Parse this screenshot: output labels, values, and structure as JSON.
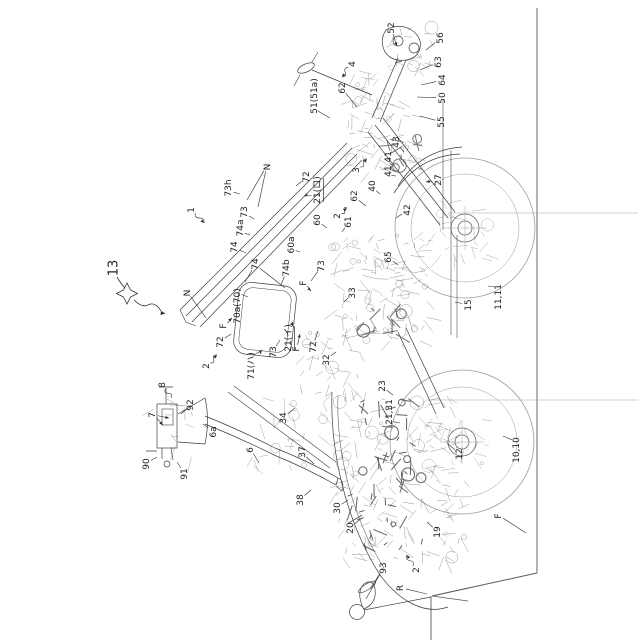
{
  "figure": {
    "kind": "patent-line-drawing",
    "orientation": "rotated-90-ccw",
    "background": "#ffffff",
    "ink": "#3a3a3a",
    "faint_ink": "#8a8a8a",
    "label_color": "#1f1f1f",
    "label_font_size": 9,
    "big_label_font_size": 13
  },
  "labels": [
    {
      "t": "13",
      "x": 113,
      "y": 268,
      "s": 13,
      "l": []
    },
    {
      "t": "1",
      "x": 191,
      "y": 210,
      "w": true,
      "a": true,
      "l": [
        [
          204,
          223
        ]
      ]
    },
    {
      "t": "2",
      "x": 337,
      "y": 216,
      "w": true,
      "a": true,
      "l": [
        [
          347,
          208
        ]
      ]
    },
    {
      "t": "2",
      "x": 206,
      "y": 366,
      "w": true,
      "a": true,
      "l": [
        [
          217,
          355
        ]
      ]
    },
    {
      "t": "2",
      "x": 416,
      "y": 570,
      "w": true,
      "a": true,
      "l": [
        [
          407,
          555
        ]
      ]
    },
    {
      "t": "3",
      "x": 356,
      "y": 170,
      "w": true,
      "a": true,
      "l": [
        [
          367,
          159
        ]
      ]
    },
    {
      "t": "4",
      "x": 352,
      "y": 64,
      "w": true,
      "a": true,
      "l": [
        [
          342,
          77
        ]
      ]
    },
    {
      "t": "52",
      "x": 391,
      "y": 28,
      "a": true,
      "l": [
        [
          397,
          46
        ]
      ]
    },
    {
      "t": "56",
      "x": 440,
      "y": 38,
      "l": [
        [
          426,
          50
        ]
      ]
    },
    {
      "t": "63",
      "x": 438,
      "y": 62,
      "l": [
        [
          420,
          70
        ]
      ]
    },
    {
      "t": "64",
      "x": 442,
      "y": 80,
      "l": [
        [
          421,
          85
        ]
      ]
    },
    {
      "t": "50",
      "x": 442,
      "y": 98,
      "l": [
        [
          417,
          97
        ]
      ]
    },
    {
      "t": "55",
      "x": 441,
      "y": 122,
      "l": [
        [
          420,
          116
        ]
      ]
    },
    {
      "t": "62",
      "x": 342,
      "y": 88,
      "l": [
        [
          357,
          107
        ]
      ]
    },
    {
      "t": "51(51a)",
      "x": 314,
      "y": 96,
      "l": [
        [
          330,
          118
        ]
      ]
    },
    {
      "t": "43",
      "x": 396,
      "y": 142,
      "l": [
        [
          404,
          152
        ]
      ]
    },
    {
      "t": "41,41",
      "x": 388,
      "y": 164,
      "l": [
        [
          396,
          176
        ]
      ]
    },
    {
      "t": "40",
      "x": 372,
      "y": 186,
      "l": [
        [
          380,
          194
        ]
      ]
    },
    {
      "t": "62",
      "x": 354,
      "y": 196,
      "l": [
        [
          366,
          206
        ]
      ]
    },
    {
      "t": "27",
      "x": 438,
      "y": 180,
      "a": true,
      "l": [
        [
          426,
          182
        ]
      ]
    },
    {
      "t": "42",
      "x": 407,
      "y": 210,
      "l": [
        [
          396,
          218
        ]
      ]
    },
    {
      "t": "21(ロ)",
      "x": 317,
      "y": 190,
      "u": true,
      "a": true,
      "l": [
        [
          304,
          196
        ]
      ]
    },
    {
      "t": "72",
      "x": 306,
      "y": 177,
      "l": [
        [
          296,
          186
        ]
      ]
    },
    {
      "t": "N",
      "x": 267,
      "y": 167,
      "l": [
        [
          247,
          200
        ],
        [
          258,
          207
        ]
      ]
    },
    {
      "t": "73h",
      "x": 228,
      "y": 188,
      "l": [
        [
          240,
          194
        ]
      ]
    },
    {
      "t": "73",
      "x": 244,
      "y": 212,
      "l": [
        [
          254,
          219
        ]
      ]
    },
    {
      "t": "74a",
      "x": 240,
      "y": 228,
      "l": [
        [
          250,
          235
        ]
      ]
    },
    {
      "t": "74",
      "x": 234,
      "y": 247,
      "l": [
        [
          246,
          253
        ]
      ]
    },
    {
      "t": "60",
      "x": 317,
      "y": 220,
      "l": [
        [
          327,
          228
        ]
      ]
    },
    {
      "t": "61",
      "x": 348,
      "y": 222,
      "l": [
        [
          342,
          232
        ]
      ]
    },
    {
      "t": "60a",
      "x": 291,
      "y": 245,
      "l": [
        [
          300,
          252
        ]
      ]
    },
    {
      "t": "74",
      "x": 255,
      "y": 264,
      "l": [
        [
          245,
          282
        ],
        [
          285,
          288
        ]
      ]
    },
    {
      "t": "74b",
      "x": 286,
      "y": 268,
      "l": [
        [
          281,
          285
        ]
      ]
    },
    {
      "t": "73",
      "x": 321,
      "y": 266,
      "l": [
        [
          311,
          281
        ]
      ]
    },
    {
      "t": "F",
      "x": 303,
      "y": 283,
      "a": true,
      "l": [
        [
          311,
          291
        ]
      ]
    },
    {
      "t": "65",
      "x": 388,
      "y": 257,
      "l": [
        [
          398,
          265
        ]
      ]
    },
    {
      "t": "33",
      "x": 352,
      "y": 293,
      "l": [
        [
          344,
          302
        ]
      ]
    },
    {
      "t": "70a(70)",
      "x": 237,
      "y": 306,
      "l": [
        [
          248,
          297
        ]
      ]
    },
    {
      "t": "N",
      "x": 187,
      "y": 293,
      "l": [
        [
          206,
          318
        ]
      ]
    },
    {
      "t": "F",
      "x": 223,
      "y": 326,
      "a": true,
      "l": [
        [
          232,
          318
        ]
      ]
    },
    {
      "t": "72",
      "x": 220,
      "y": 342,
      "l": [
        [
          231,
          334
        ]
      ]
    },
    {
      "t": "71(ハ)",
      "x": 251,
      "y": 366,
      "a": true,
      "l": [
        [
          262,
          350
        ]
      ]
    },
    {
      "t": "73",
      "x": 273,
      "y": 352,
      "l": [
        [
          280,
          340
        ]
      ]
    },
    {
      "t": "21(イ)",
      "x": 288,
      "y": 338,
      "u": true,
      "a": true,
      "l": [
        [
          293,
          322
        ]
      ]
    },
    {
      "t": "F",
      "x": 296,
      "y": 349,
      "a": true,
      "l": [
        [
          300,
          334
        ]
      ]
    },
    {
      "t": "72",
      "x": 313,
      "y": 347,
      "l": [
        [
          318,
          331
        ]
      ]
    },
    {
      "t": "32",
      "x": 326,
      "y": 360,
      "l": [
        [
          336,
          352
        ]
      ]
    },
    {
      "t": "34",
      "x": 283,
      "y": 418,
      "l": [
        [
          295,
          408
        ]
      ]
    },
    {
      "t": "8",
      "x": 162,
      "y": 385,
      "w": true,
      "l": [
        [
          171,
          398
        ]
      ]
    },
    {
      "t": "92",
      "x": 190,
      "y": 405,
      "l": [
        [
          181,
          414
        ]
      ]
    },
    {
      "t": "7",
      "x": 152,
      "y": 415,
      "a": true,
      "l": [
        [
          163,
          425
        ],
        [
          169,
          418
        ]
      ]
    },
    {
      "t": "90",
      "x": 146,
      "y": 464,
      "l": [
        [
          157,
          457
        ]
      ]
    },
    {
      "t": "91",
      "x": 184,
      "y": 474,
      "l": [
        [
          177,
          462
        ]
      ]
    },
    {
      "t": "6a",
      "x": 213,
      "y": 432,
      "l": [
        [
          203,
          424
        ]
      ]
    },
    {
      "t": "6",
      "x": 250,
      "y": 450,
      "l": [
        [
          259,
          463
        ]
      ]
    },
    {
      "t": "37",
      "x": 302,
      "y": 452,
      "l": [
        [
          314,
          464
        ]
      ]
    },
    {
      "t": "38",
      "x": 300,
      "y": 500,
      "l": [
        [
          311,
          490
        ]
      ]
    },
    {
      "t": "23",
      "x": 382,
      "y": 386,
      "l": [
        [
          393,
          395
        ]
      ]
    },
    {
      "t": "21,31",
      "x": 389,
      "y": 412,
      "l": [
        [
          400,
          423
        ]
      ]
    },
    {
      "t": "12",
      "x": 459,
      "y": 454,
      "l": [
        [
          447,
          443
        ]
      ]
    },
    {
      "t": "10,10",
      "x": 516,
      "y": 450,
      "l": [
        [
          503,
          436
        ]
      ]
    },
    {
      "t": "30",
      "x": 337,
      "y": 508,
      "l": [
        [
          348,
          500
        ]
      ]
    },
    {
      "t": "20",
      "x": 350,
      "y": 528,
      "l": [
        [
          362,
          518
        ]
      ]
    },
    {
      "t": "19",
      "x": 437,
      "y": 532,
      "l": [
        [
          427,
          522
        ]
      ]
    },
    {
      "t": "93",
      "x": 383,
      "y": 568,
      "l": [
        [
          370,
          589
        ],
        [
          366,
          599
        ]
      ]
    },
    {
      "t": "R",
      "x": 400,
      "y": 588,
      "l": [
        [
          427,
          594
        ]
      ]
    },
    {
      "t": "F",
      "x": 498,
      "y": 516,
      "l": [
        [
          526,
          533
        ]
      ]
    },
    {
      "t": "15",
      "x": 468,
      "y": 305,
      "l": [
        [
          455,
          302
        ]
      ]
    },
    {
      "t": "11,11",
      "x": 498,
      "y": 297,
      "l": [
        [
          488,
          286
        ]
      ]
    }
  ]
}
